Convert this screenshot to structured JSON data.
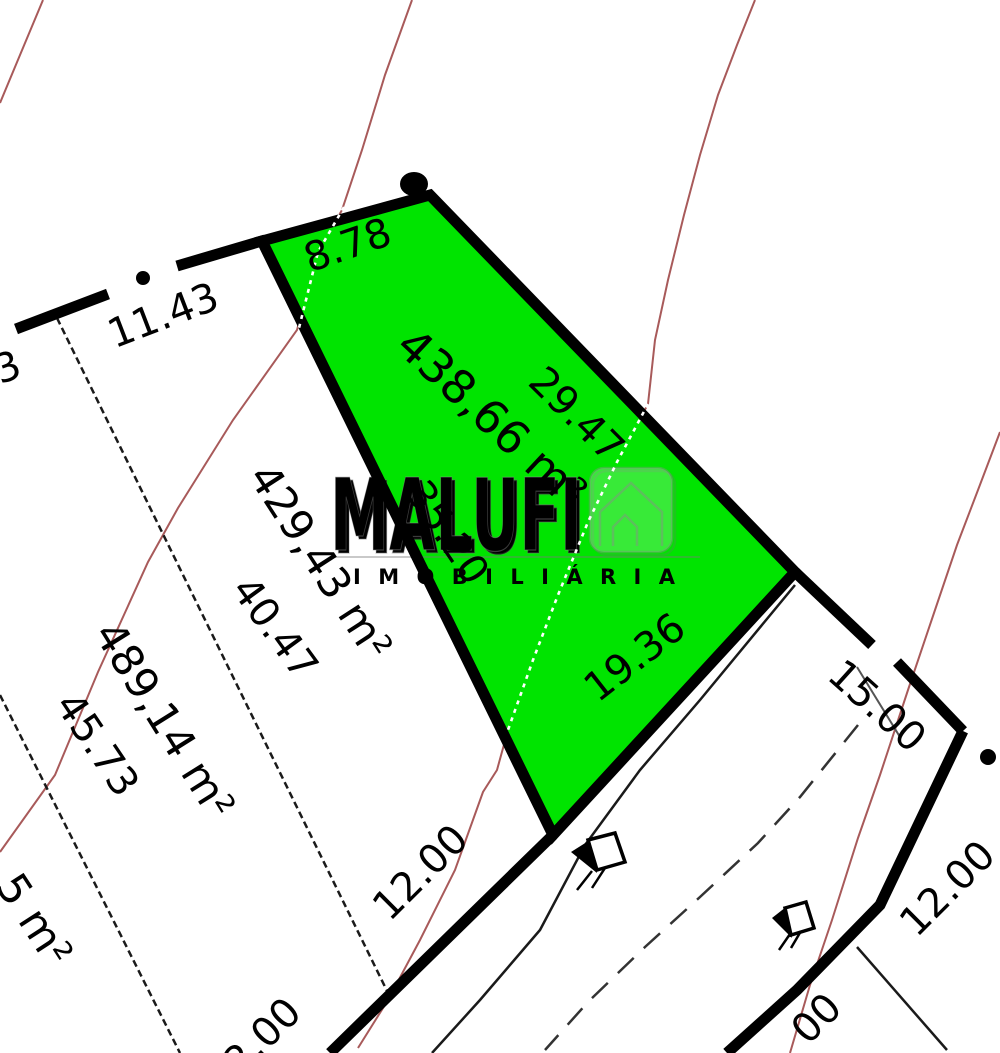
{
  "map": {
    "colors": {
      "lot_fill": "#00e400",
      "boundary": "#000000",
      "contour_line": "#a85a5a",
      "watermark_gray": "#8a8080"
    },
    "highlight_lot": {
      "area": "438,66 m²",
      "side_top": "8.78",
      "side_right": "29.47",
      "side_left": "35.20",
      "side_front": "19.36"
    },
    "left_lot": {
      "area": "429,43 m²",
      "side": "40.47",
      "frontage": "12.00"
    },
    "far_left_lot": {
      "area": "489,14 m²",
      "side": "45.73",
      "frontage_fragment": "2.00"
    },
    "corner_lot_fragment": {
      "area_fragment": "5 m²"
    },
    "streets": {
      "upper_frontage": "11.43",
      "corner_gap": "15.00",
      "across_frontage": "12.00",
      "across_frontage_fragment": "00",
      "left_edge_fragment": "3"
    },
    "watermark": {
      "brand": "MALUFI",
      "subtitle": "IMOBILIÁRIA"
    }
  }
}
